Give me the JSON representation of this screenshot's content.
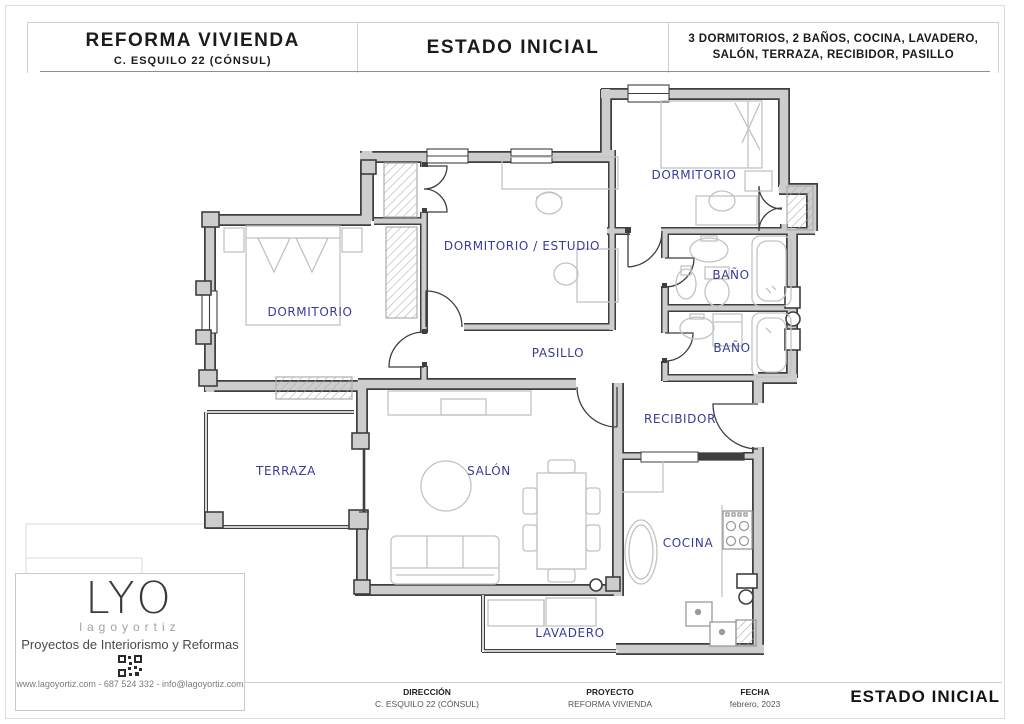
{
  "header": {
    "project_title": "REFORMA VIVIENDA",
    "project_address": "C. ESQUILO 22 (CÓNSUL)",
    "sheet_title": "ESTADO INICIAL",
    "program_line1": "3 DORMITORIOS, 2 BAÑOS, COCINA, LAVADERO,",
    "program_line2": "SALÓN, TERRAZA, RECIBIDOR, PASILLO"
  },
  "floorplan": {
    "label_color": "#3a3a99",
    "wall_fill": "#cdcdcd",
    "wall_outline": "#3f3f3f",
    "furniture_color": "#c2c2c2",
    "rooms": [
      {
        "id": "dormitorio-norte",
        "label": "DORMITORIO"
      },
      {
        "id": "dormitorio-estudio",
        "label": "DORMITORIO / ESTUDIO"
      },
      {
        "id": "dormitorio-principal",
        "label": "DORMITORIO"
      },
      {
        "id": "bano-1",
        "label": "BAÑO"
      },
      {
        "id": "bano-2",
        "label": "BAÑO"
      },
      {
        "id": "pasillo",
        "label": "PASILLO"
      },
      {
        "id": "recibidor",
        "label": "RECIBIDOR"
      },
      {
        "id": "terraza",
        "label": "TERRAZA"
      },
      {
        "id": "salon",
        "label": "SALÓN"
      },
      {
        "id": "cocina",
        "label": "COCINA"
      },
      {
        "id": "lavadero",
        "label": "LAVADERO"
      }
    ]
  },
  "logo_card": {
    "brand": "LYO",
    "brand_sub": "lagoyortiz",
    "tagline": "Proyectos de Interiorismo y Reformas",
    "contact": "www.lagoyortiz.com  -  687 524 332  -  info@lagoyortiz.com"
  },
  "footer": {
    "fields": [
      {
        "label": "DIRECCIÓN",
        "value": "C. ESQUILO 22 (CÓNSUL)"
      },
      {
        "label": "PROYECTO",
        "value": "REFORMA VIVIENDA"
      },
      {
        "label": "FECHA",
        "value": "febrero, 2023"
      }
    ],
    "sheet_title": "ESTADO INICIAL"
  }
}
